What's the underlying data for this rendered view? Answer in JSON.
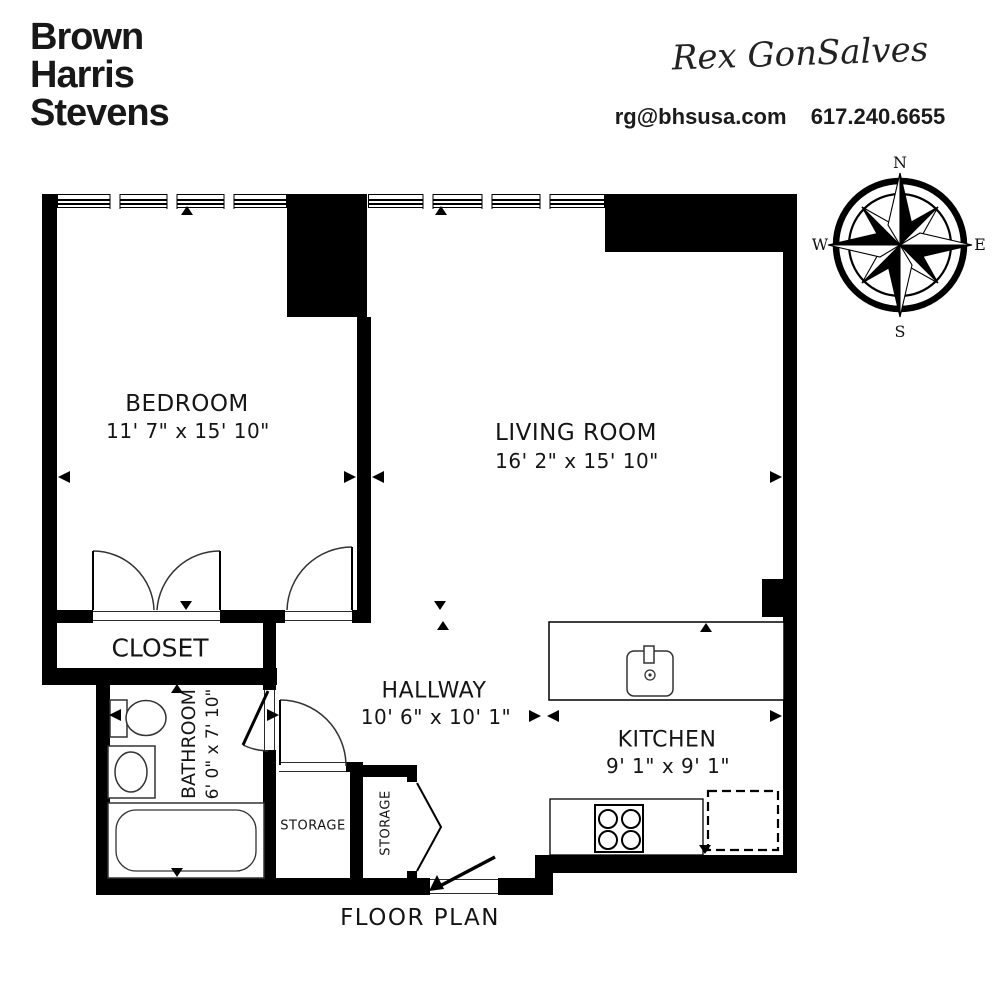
{
  "branding": {
    "logo_lines": [
      "Brown",
      "Harris",
      "Stevens"
    ],
    "agent_signature": "Rex GonSalves",
    "email": "rg@bhsusa.com",
    "phone": "617.240.6655"
  },
  "compass": {
    "n": "N",
    "e": "E",
    "s": "S",
    "w": "W"
  },
  "rooms": [
    {
      "name": "BEDROOM",
      "dims": "11' 7\" x 15' 10\""
    },
    {
      "name": "LIVING ROOM",
      "dims": "16' 2\" x 15' 10\""
    },
    {
      "name": "CLOSET",
      "dims": ""
    },
    {
      "name": "HALLWAY",
      "dims": "10' 6\" x 10' 1\""
    },
    {
      "name": "KITCHEN",
      "dims": "9' 1\" x 9' 1\""
    },
    {
      "name": "BATHROOM",
      "dims": "6' 0\" x 7' 10\""
    },
    {
      "name": "STORAGE"
    },
    {
      "name": "STORAGE"
    }
  ],
  "footer": {
    "title": "FLOOR PLAN"
  },
  "colors": {
    "wall": "#000000",
    "line": "#333333"
  }
}
